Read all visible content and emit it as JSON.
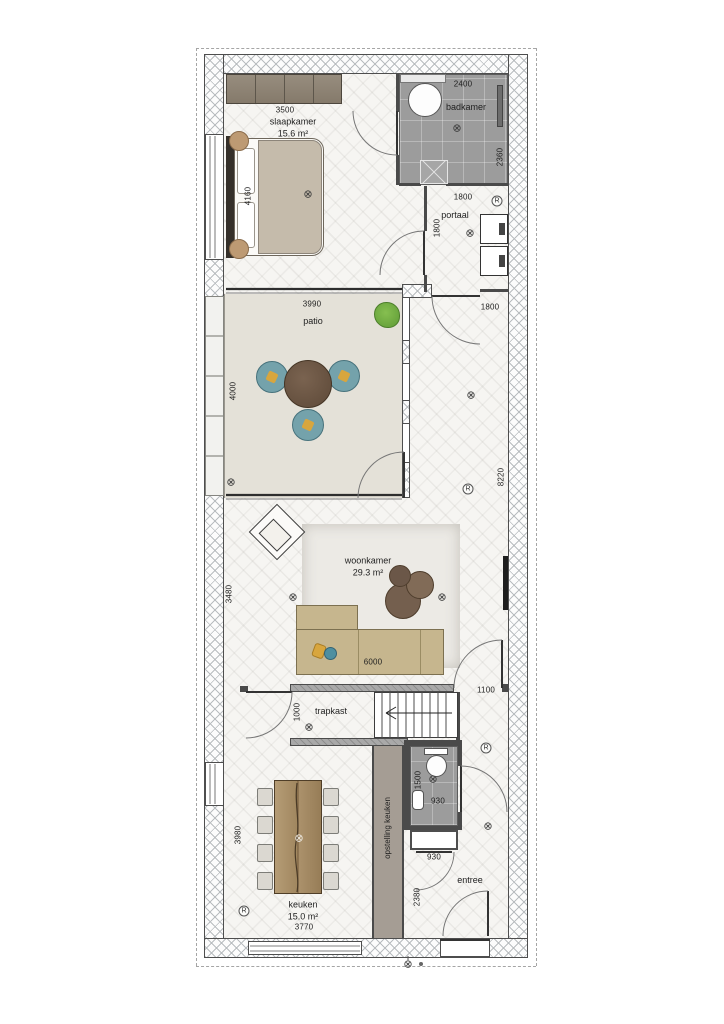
{
  "rooms": {
    "slaapkamer": {
      "name": "slaapkamer",
      "area": "15.6 m²"
    },
    "badkamer": {
      "name": "badkamer"
    },
    "portaal": {
      "name": "portaal"
    },
    "patio": {
      "name": "patio"
    },
    "woonkamer": {
      "name": "woonkamer",
      "area": "29.3 m²"
    },
    "trapkast": {
      "name": "trapkast"
    },
    "opstelling": {
      "name": "opstelling keuken"
    },
    "keuken": {
      "name": "keuken",
      "area": "15.0 m²"
    },
    "entree": {
      "name": "entree"
    }
  },
  "dimensions": {
    "wardrobe": "3500",
    "bed": "4160",
    "bath_width": "2400",
    "bath_height": "2360",
    "hall_bath": "1800",
    "portaal_height": "1800",
    "corridor_width": "1800",
    "patio_width": "3990",
    "patio_height": "4000",
    "east_side": "8220",
    "living_height": "3480",
    "sofa": "6000",
    "living_door": "1100",
    "trapkast_width": "1000",
    "wc_height": "1500",
    "wc_width": "930",
    "cabinet_width": "930",
    "kitchen_height": "3980",
    "kitchen_width": "3770",
    "entree_height": "2380"
  },
  "symbols": {
    "light": "⊗",
    "detector": "R"
  },
  "colors": {
    "bath_tile": "#9c9c9c",
    "patio_floor": "#e4e1d8",
    "wood": "#a78c66",
    "sofa": "#c6b68e",
    "chair_teal": "#74a2ab",
    "cushion_yellow": "#d8a63e",
    "plant_green": "#6aa63e",
    "kitchen_strip": "#a59d94"
  }
}
